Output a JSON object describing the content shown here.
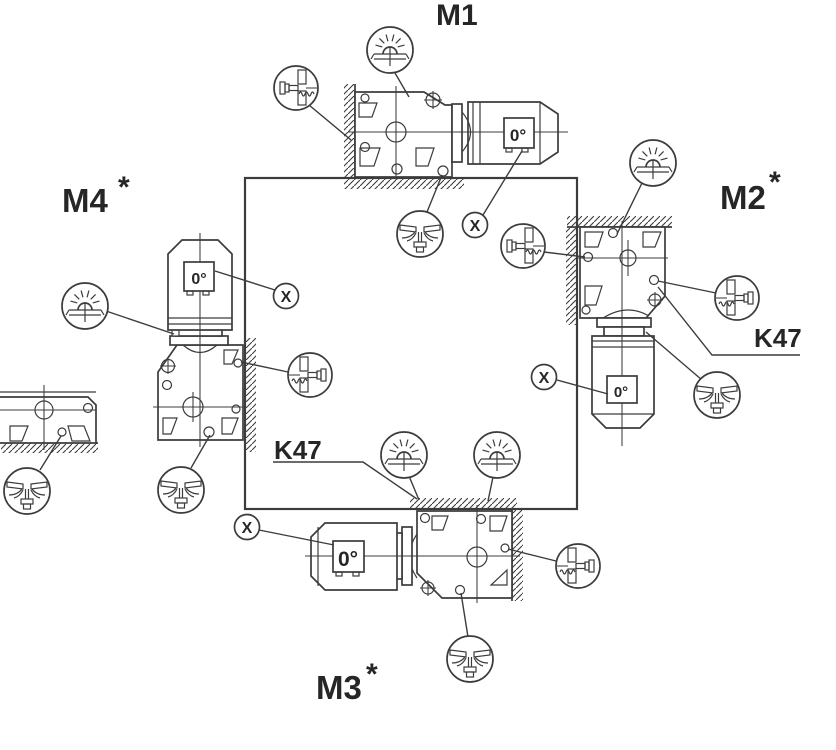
{
  "colors": {
    "background": "#ffffff",
    "line": "#3c3c3c",
    "text": "#262626"
  },
  "labels": {
    "m1": "M1",
    "m2": "M2",
    "m2_note": "*",
    "m3": "M3",
    "m3_note": "*",
    "m4": "M4",
    "m4_note": "*",
    "k47_right": "K47",
    "k47_bottom": "K47",
    "x_marker": "X",
    "terminal_angle": "0°"
  },
  "icons": {
    "breather_valve": "dome-with-radiating-vent-lines",
    "oil_level_plug": "screw-into-hatched-wall-with-oil-level-squiggle",
    "oil_drain_plug": "bottom-plug-with-oil-flow-lines",
    "x_marker": "circled-letter-x"
  }
}
